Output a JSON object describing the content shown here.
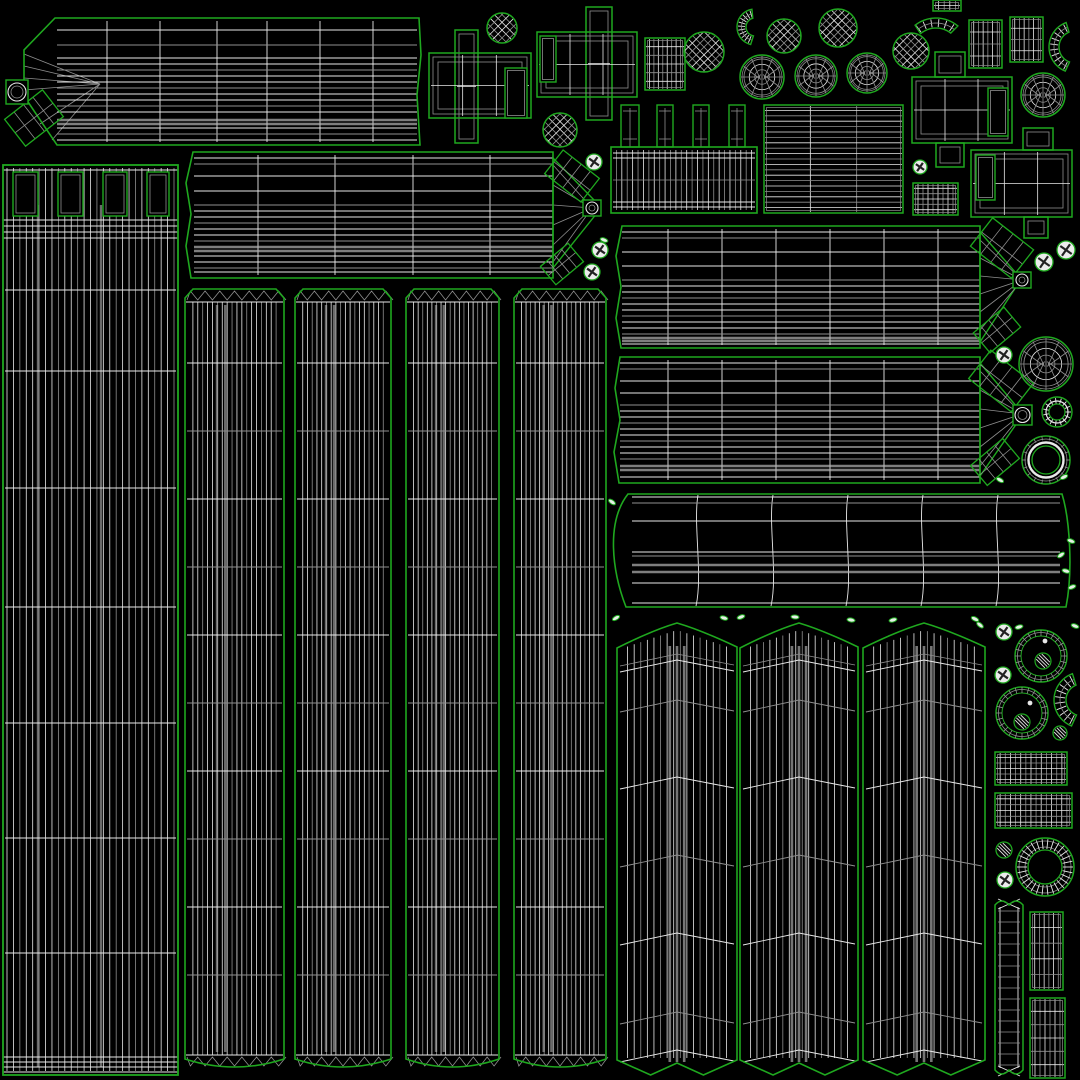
{
  "canvas": {
    "w": 1080,
    "h": 1080,
    "bg": "#000000"
  },
  "palette": {
    "outline": "#1fa81f",
    "wire": "#e9e9e9",
    "wire_dim": "#8f8f8f",
    "wire_gray": "#b3b3b3",
    "screw_fill": "#ececec",
    "chip_fill": "#e7efe7",
    "dark": "#222222"
  },
  "bars": [
    {
      "name": "bar-top-left",
      "outline": [
        [
          55,
          18
        ],
        [
          419,
          18
        ],
        [
          421,
          55
        ],
        [
          417,
          95
        ],
        [
          420,
          145
        ],
        [
          57,
          145
        ],
        [
          24,
          96
        ],
        [
          24,
          50
        ]
      ],
      "lx": 57,
      "rx": 417,
      "top": 18,
      "bot": 145,
      "vdivs": [
        107,
        160,
        217,
        267,
        320,
        373
      ],
      "rows_b": [
        30,
        45,
        58,
        64,
        70,
        76,
        82,
        88,
        94,
        100,
        106,
        112,
        128,
        134,
        140
      ],
      "rows_g": [
        120,
        124
      ],
      "fan": {
        "apex": [
          100,
          84
        ],
        "src": [
          [
            24,
            54
          ],
          [
            24,
            66
          ],
          [
            24,
            78
          ],
          [
            24,
            90
          ],
          [
            40,
            124
          ],
          [
            52,
            140
          ]
        ]
      }
    },
    {
      "name": "bar-mid-left",
      "outline": [
        [
          193,
          152
        ],
        [
          553,
          152
        ],
        [
          553,
          278
        ],
        [
          191,
          278
        ],
        [
          186,
          246
        ],
        [
          191,
          214
        ],
        [
          186,
          183
        ]
      ],
      "lx": 194,
      "rx": 553,
      "top": 152,
      "bot": 278,
      "vdivs": [
        258,
        335,
        413,
        490
      ],
      "rows_b": [
        158,
        164,
        176,
        191,
        205,
        211,
        217,
        223,
        229,
        235,
        241,
        256,
        262,
        268,
        272
      ],
      "rows_g": [
        247,
        251
      ],
      "fan": {
        "wedge": [
          [
            553,
            158
          ],
          [
            597,
            203
          ],
          [
            597,
            213
          ],
          [
            553,
            268
          ]
        ],
        "apex": [
          592,
          208
        ],
        "src": [
          [
            553,
            165
          ],
          [
            553,
            185
          ],
          [
            553,
            205
          ],
          [
            553,
            225
          ],
          [
            553,
            245
          ],
          [
            553,
            262
          ]
        ]
      }
    },
    {
      "name": "bar-right-1",
      "outline": [
        [
          622,
          226
        ],
        [
          980,
          226
        ],
        [
          980,
          348
        ],
        [
          621,
          348
        ],
        [
          616,
          318
        ],
        [
          621,
          287
        ],
        [
          616,
          256
        ]
      ],
      "lx": 622,
      "rx": 980,
      "top": 226,
      "bot": 348,
      "vdivs": [
        668,
        722,
        776,
        830,
        884,
        938
      ],
      "rows_b": [
        232,
        238,
        252,
        266,
        280,
        286,
        292,
        298,
        304,
        310,
        316,
        322,
        328,
        334,
        344
      ],
      "rows_g": [
        338,
        341
      ],
      "fan": {
        "wedge": [
          [
            980,
            232
          ],
          [
            1016,
            273
          ],
          [
            1016,
            287
          ],
          [
            980,
            342
          ]
        ],
        "apex": [
          1022,
          280
        ],
        "src": [
          [
            980,
            240
          ],
          [
            980,
            258
          ],
          [
            980,
            276
          ],
          [
            980,
            294
          ],
          [
            980,
            312
          ],
          [
            980,
            330
          ]
        ]
      }
    },
    {
      "name": "bar-right-2",
      "outline": [
        [
          620,
          357
        ],
        [
          980,
          357
        ],
        [
          980,
          483
        ],
        [
          619,
          483
        ],
        [
          614,
          452
        ],
        [
          620,
          420
        ],
        [
          615,
          388
        ]
      ],
      "lx": 620,
      "rx": 980,
      "top": 357,
      "bot": 483,
      "vdivs": [
        668,
        722,
        776,
        830,
        884,
        938
      ],
      "rows_b": [
        363,
        369,
        381,
        393,
        405,
        411,
        417,
        423,
        429,
        435,
        441,
        447,
        453,
        459,
        477
      ],
      "rows_g": [
        466,
        470
      ],
      "fan": {
        "wedge": [
          [
            980,
            363
          ],
          [
            1017,
            407
          ],
          [
            1017,
            423
          ],
          [
            980,
            476
          ]
        ],
        "apex": [
          1022,
          414
        ],
        "src": [
          [
            980,
            371
          ],
          [
            980,
            390
          ],
          [
            980,
            409
          ],
          [
            980,
            428
          ],
          [
            980,
            447
          ],
          [
            980,
            466
          ]
        ]
      }
    }
  ],
  "tower": {
    "x": 3,
    "y": 165,
    "w": 175,
    "h": 910,
    "nv": 26,
    "gray_v": [
      0.2,
      0.56
    ],
    "band_rows": [
      220,
      226,
      232,
      238
    ],
    "major_rows": [
      290,
      371,
      488,
      607,
      723,
      838,
      953
    ],
    "bottom_rows": [
      1057,
      1062,
      1067,
      1072
    ],
    "holes": [
      [
        13,
        172,
        25,
        44
      ],
      [
        58,
        172,
        25,
        44
      ],
      [
        103,
        172,
        24,
        44
      ],
      [
        147,
        172,
        22,
        44
      ]
    ]
  },
  "strips": {
    "y": 285,
    "h": 787,
    "nv": 19,
    "panels": [
      {
        "x": 183,
        "w": 103
      },
      {
        "x": 293,
        "w": 100
      },
      {
        "x": 404,
        "w": 97
      },
      {
        "x": 512,
        "w": 96
      }
    ]
  },
  "curtains": {
    "y": 620,
    "h": 458,
    "rows": [
      660,
      700,
      777,
      855,
      933,
      1012,
      1050
    ],
    "panels": [
      {
        "x": 617,
        "w": 120
      },
      {
        "x": 740,
        "w": 118
      },
      {
        "x": 863,
        "w": 122
      }
    ]
  },
  "band": {
    "left": 612,
    "right": 1066,
    "top": 494,
    "bot": 607,
    "divs": [
      698,
      773,
      848,
      923,
      998
    ],
    "rows_b": [
      497,
      503,
      521,
      552,
      556,
      583,
      603
    ],
    "rows_g": [
      565,
      572
    ],
    "lx": 632,
    "rx": 1060
  },
  "comb": {
    "x": 611,
    "y": 147,
    "w": 146,
    "h": 66,
    "teeth": [
      [
        621,
        105,
        18,
        42
      ],
      [
        657,
        105,
        16,
        42
      ],
      [
        693,
        105,
        16,
        42
      ],
      [
        729,
        105,
        16,
        42
      ]
    ]
  },
  "crosses": [
    {
      "rects": [
        [
          455,
          30,
          23,
          113
        ],
        [
          429,
          53,
          102,
          65
        ]
      ],
      "hole": [
        505,
        68,
        22,
        50
      ]
    },
    {
      "rects": [
        [
          586,
          7,
          26,
          113
        ],
        [
          537,
          32,
          100,
          65
        ]
      ],
      "hole": [
        540,
        36,
        16,
        46
      ]
    },
    {
      "rects": [
        [
          935,
          52,
          30,
          25
        ],
        [
          912,
          77,
          100,
          66
        ],
        [
          936,
          143,
          28,
          24
        ]
      ],
      "hole": [
        988,
        88,
        20,
        48
      ]
    },
    {
      "rects": [
        [
          1023,
          128,
          30,
          22
        ],
        [
          971,
          150,
          101,
          67
        ],
        [
          1024,
          217,
          24,
          21
        ]
      ],
      "hole": [
        976,
        155,
        19,
        45
      ]
    }
  ],
  "grids": [
    [
      645,
      38,
      40,
      52,
      9,
      6
    ],
    [
      764,
      105,
      139,
      108,
      3,
      20
    ],
    [
      969,
      20,
      33,
      48,
      7,
      4
    ],
    [
      1010,
      17,
      33,
      45,
      7,
      4
    ],
    [
      913,
      183,
      45,
      32,
      9,
      6
    ],
    [
      933,
      0,
      28,
      11,
      5,
      2
    ],
    [
      995,
      752,
      72,
      33,
      14,
      6
    ],
    [
      995,
      793,
      77,
      35,
      15,
      6
    ],
    [
      1030,
      912,
      33,
      78,
      7,
      5
    ],
    [
      1030,
      998,
      35,
      80,
      7,
      6
    ]
  ],
  "rquads": [
    [
      572,
      176,
      46,
      30,
      38
    ],
    [
      562,
      264,
      36,
      24,
      -40
    ],
    [
      1002,
      248,
      52,
      36,
      38
    ],
    [
      997,
      330,
      40,
      26,
      -40
    ],
    [
      1001,
      381,
      54,
      36,
      38
    ],
    [
      995,
      462,
      42,
      26,
      -40
    ],
    [
      34,
      118,
      48,
      34,
      -38
    ]
  ],
  "knobs": [
    [
      6,
      80,
      22,
      24
    ],
    [
      583,
      200,
      18,
      16
    ],
    [
      1013,
      272,
      18,
      16
    ],
    [
      1013,
      405,
      19,
      20
    ]
  ],
  "circles": {
    "lattice": [
      [
        502,
        28,
        15
      ],
      [
        560,
        130,
        17
      ],
      [
        704,
        52,
        20
      ],
      [
        784,
        36,
        17
      ],
      [
        838,
        28,
        19
      ],
      [
        911,
        51,
        18
      ]
    ],
    "polar": [
      [
        762,
        77,
        22
      ],
      [
        816,
        76,
        21
      ],
      [
        867,
        73,
        20
      ],
      [
        1043,
        95,
        22
      ],
      [
        1046,
        364,
        27
      ]
    ],
    "ring_thin": [
      {
        "c": [
          1041,
          656
        ],
        "r": 26,
        "hatch": [
          1043,
          661,
          8
        ],
        "dot": [
          1045,
          641
        ]
      },
      {
        "c": [
          1022,
          713
        ],
        "r": 26,
        "hatch": [
          1022,
          722,
          8
        ],
        "dot": [
          1030,
          703
        ]
      }
    ],
    "donut": [
      [
        1046,
        460,
        24,
        14
      ]
    ],
    "gear_ring": [
      [
        1045,
        867,
        29,
        17
      ]
    ],
    "gear_small": [
      [
        1057,
        412,
        15,
        8
      ]
    ]
  },
  "arcs": [
    [
      755,
      27,
      18,
      9,
      100,
      260
    ],
    [
      936,
      52,
      34,
      24,
      50,
      130
    ],
    [
      1075,
      47,
      26,
      16,
      110,
      250
    ],
    [
      1082,
      700,
      28,
      16,
      110,
      250
    ]
  ],
  "ladder": {
    "x": 995,
    "y": 897,
    "w": 28,
    "h": 181
  },
  "screws": [
    [
      594,
      162,
      8
    ],
    [
      600,
      250,
      8
    ],
    [
      592,
      272,
      8
    ],
    [
      920,
      167,
      7
    ],
    [
      1044,
      262,
      9
    ],
    [
      1066,
      250,
      9
    ],
    [
      1004,
      355,
      8
    ],
    [
      1004,
      632,
      8
    ],
    [
      1003,
      675,
      8
    ],
    [
      1005,
      880,
      8
    ]
  ],
  "hatches": [
    [
      1060,
      733,
      7
    ],
    [
      1004,
      850,
      8
    ]
  ],
  "chips": [
    [
      604,
      240,
      20
    ],
    [
      612,
      502,
      35
    ],
    [
      616,
      618,
      -30
    ],
    [
      724,
      618,
      15
    ],
    [
      741,
      617,
      -20
    ],
    [
      795,
      617,
      5
    ],
    [
      851,
      620,
      10
    ],
    [
      893,
      620,
      -15
    ],
    [
      975,
      619,
      25
    ],
    [
      980,
      625,
      40
    ],
    [
      1019,
      627,
      -15
    ],
    [
      1000,
      480,
      30
    ],
    [
      1064,
      477,
      -25
    ],
    [
      1071,
      541,
      20
    ],
    [
      1061,
      555,
      -35
    ],
    [
      1066,
      571,
      15
    ],
    [
      1072,
      587,
      -20
    ],
    [
      1075,
      626,
      20
    ]
  ]
}
